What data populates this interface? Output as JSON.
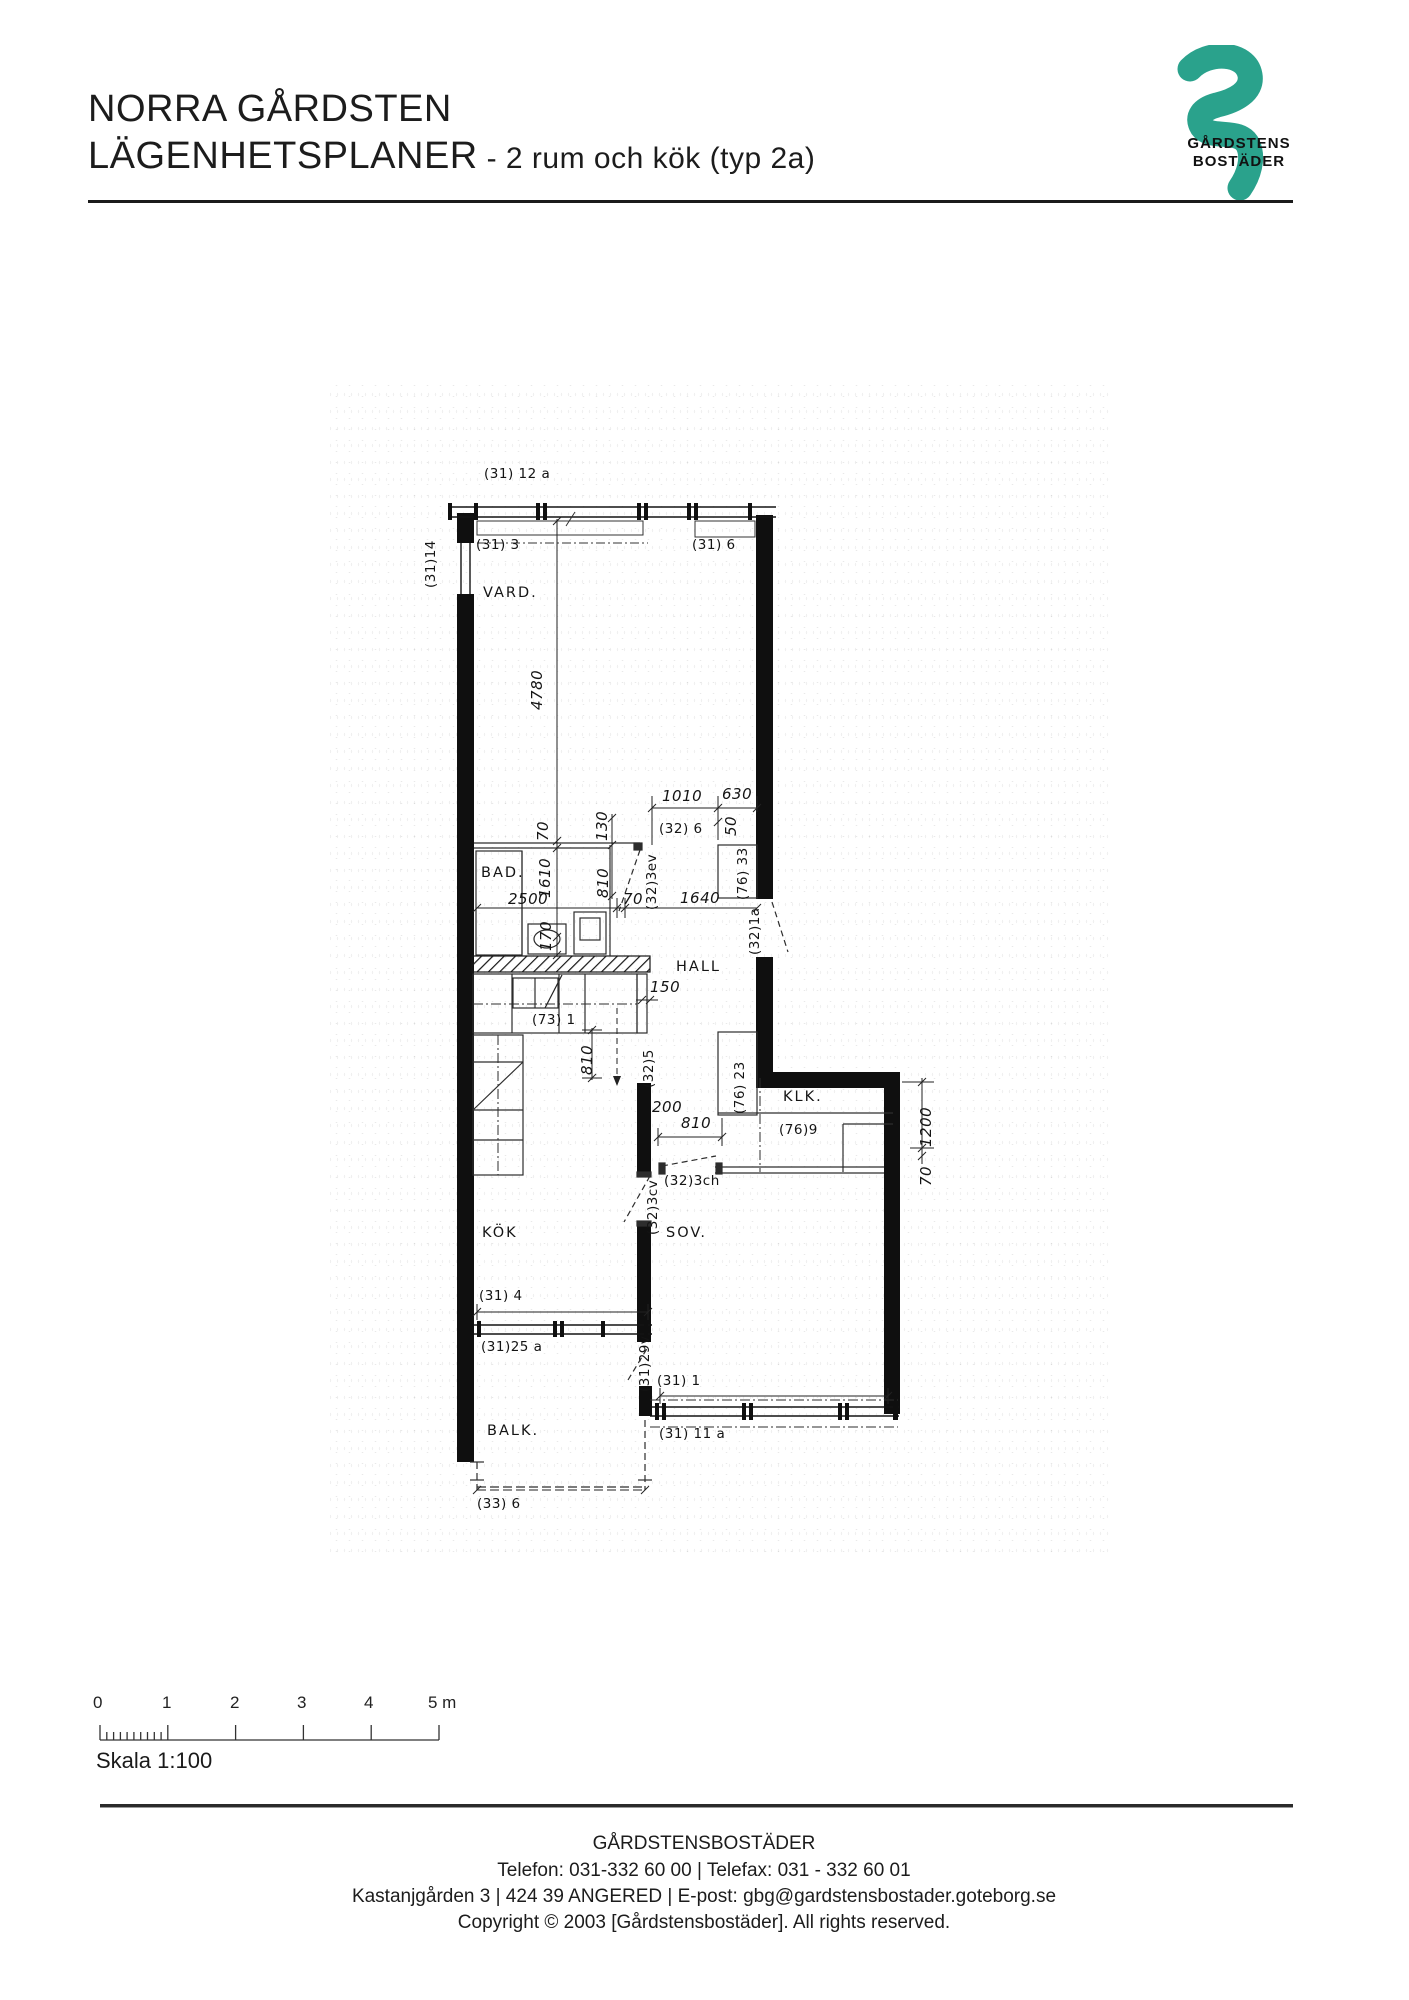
{
  "header": {
    "title_line1": "NORRA GÅRDSTEN",
    "title_line2": "LÄGENHETSPLANER",
    "title_suffix": " - 2 rum och kök (typ 2a)"
  },
  "logo": {
    "name_line1": "GÅRDSTENS",
    "name_line2": "BOSTÄDER",
    "accent_color": "#2aa28c"
  },
  "plan": {
    "rooms": {
      "vard": "VARD.",
      "bad": "BAD.",
      "hall": "HALL",
      "klk": "KLK.",
      "kok": "KÖK",
      "sov": "SOV.",
      "balk": "BALK."
    },
    "codes": {
      "c31_12a": "(31) 12 a",
      "c31_3": "(31) 3",
      "c31_6": "(31) 6",
      "c31_14": "(31)14",
      "c32_6": "(32) 6",
      "c76_33": "(76) 33",
      "c32_3ev": "(32)3ev",
      "c32_1a": "(32)1a",
      "c73_1": "(73) 1",
      "c32_5": "(32)5",
      "c76_23": "(76) 23",
      "c76_9": "(76)9",
      "c32_3ch": "(32)3ch",
      "c32_3cv": "(32)3cv",
      "c31_4": "(31) 4",
      "c31_25a": "(31)25 a",
      "c31_29v": "(31)29v",
      "c31_1": "(31) 1",
      "c31_11a": "(31) 11 a",
      "c33_6": "(33) 6"
    },
    "dims": {
      "d4780": "4780",
      "d1010": "1010",
      "d630": "630",
      "d50": "50",
      "d70": "70",
      "d130": "130",
      "d1610": "1610",
      "d810": "810",
      "d2500": "2500",
      "d1640": "1640",
      "d170": "170",
      "d150": "150",
      "d200": "200",
      "d1200": "1200"
    }
  },
  "scalebar": {
    "labels": [
      "0",
      "1",
      "2",
      "3",
      "4",
      "5 m"
    ],
    "caption": "Skala 1:100"
  },
  "footer": {
    "line1": "GÅRDSTENSBOSTÄDER",
    "line2": "Telefon: 031-332 60 00 | Telefax: 031 - 332 60 01",
    "line3": "Kastanjgården 3 | 424 39 ANGERED | E-post: gbg@gardstensbostader.goteborg.se",
    "line4": "Copyright © 2003 [Gårdstensbostäder]. All rights reserved."
  }
}
